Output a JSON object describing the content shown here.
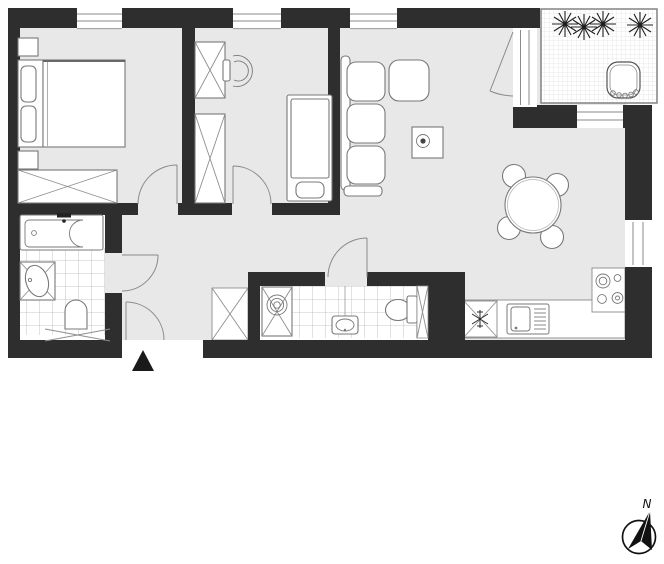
{
  "meta": {
    "title": "apartment-floor-plan"
  },
  "colors": {
    "wall": "#2e2e2e",
    "floor": "#e8e8e8",
    "line": "#787878",
    "paper": "#ffffff",
    "tile_line": "#b8b8b8",
    "balcony_grid": "#d6d6d6",
    "ink": "#1a1a1a"
  },
  "compass": {
    "north_label": "N"
  },
  "plan": {
    "rooms": [
      {
        "name": "bedroom",
        "fixtures": [
          "double-bed",
          "pillows",
          "headboard",
          "nightstand-top",
          "nightstand-bottom",
          "wardrobe-x"
        ]
      },
      {
        "name": "kids-room",
        "fixtures": [
          "wardrobe-x-upper",
          "wardrobe-x-lower",
          "tub-chair",
          "single-bed",
          "pillow"
        ]
      },
      {
        "name": "living-room",
        "fixtures": [
          "corner-sofa",
          "ottoman",
          "coffee-table-with-bowl",
          "dining-table-round",
          "dining-chairs-x4"
        ]
      },
      {
        "name": "kitchen",
        "fixtures": [
          "cooktop-4-burners",
          "counter",
          "fridge-snowflake",
          "sink-with-drainboard"
        ]
      },
      {
        "name": "bathroom-1",
        "fixtures": [
          "bathtub",
          "vanity-sink",
          "toilet",
          "radiator-x",
          "tile-floor"
        ]
      },
      {
        "name": "bathroom-2",
        "fixtures": [
          "washing-machine",
          "pedestal-sink",
          "toilet",
          "vent-shaft-x",
          "tile-floor"
        ]
      },
      {
        "name": "hallway",
        "fixtures": [
          "closet-x",
          "entrance-door"
        ]
      },
      {
        "name": "balcony",
        "fixtures": [
          "plant",
          "plant",
          "plant",
          "plant",
          "wicker-chair",
          "tile-grid",
          "glass-door"
        ]
      }
    ],
    "windows": [
      "bedroom-top",
      "kids-room-top",
      "living-top",
      "living-right-of-balcony",
      "kitchen-right"
    ],
    "doors": [
      "entrance",
      "bedroom",
      "kids-room",
      "bathroom-1",
      "bathroom-2",
      "balcony-glass"
    ]
  }
}
